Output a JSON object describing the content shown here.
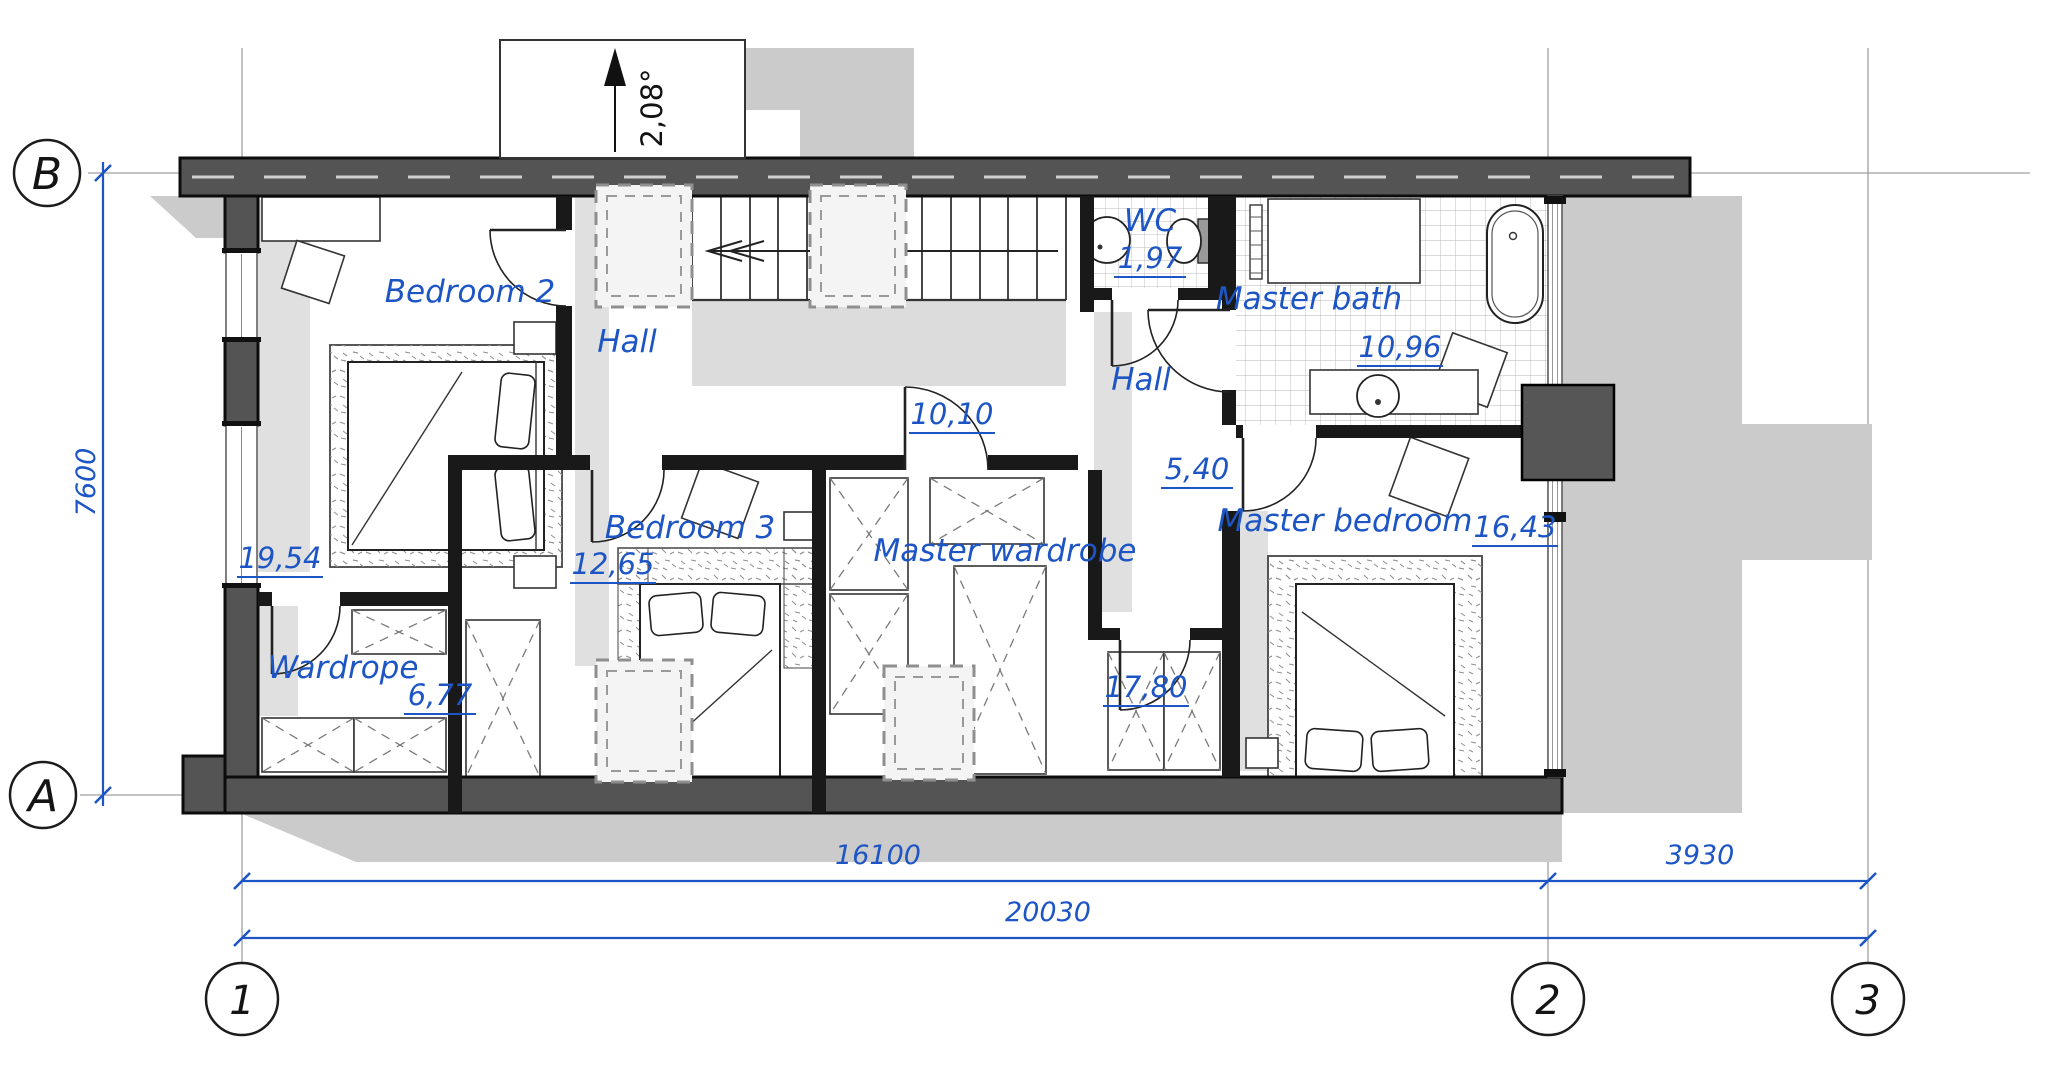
{
  "rooms": {
    "bedroom2": {
      "label": "Bedroom 2",
      "area": "19,54"
    },
    "hall1": {
      "label": "Hall",
      "area": "10,10"
    },
    "wc": {
      "label": "WC",
      "area": "1,97"
    },
    "master_bath": {
      "label": "Master bath",
      "area": "10,96"
    },
    "hall2": {
      "label": "Hall",
      "area": "5,40"
    },
    "bedroom3": {
      "label": "Bedroom 3",
      "area": "12,65"
    },
    "master_wardrobe": {
      "label": "Master wardrobe",
      "area": "17,80"
    },
    "wardrope": {
      "label": "Wardrope",
      "area": "6,77"
    },
    "master_bedroom": {
      "label": "Master bedroom",
      "area": "16,43"
    }
  },
  "grid": {
    "row_b": "B",
    "row_a": "A",
    "col_1": "1",
    "col_2": "2",
    "col_3": "3"
  },
  "dimensions": {
    "height_left": "7600",
    "bottom_left": "16100",
    "bottom_right": "3930",
    "bottom_total": "20030",
    "roof_slope": "2,08°"
  },
  "colors": {
    "annotation": "#1d55c4",
    "wall_dark": "#545454",
    "wall_black": "#191919",
    "shadow": "#cbcbcb"
  }
}
